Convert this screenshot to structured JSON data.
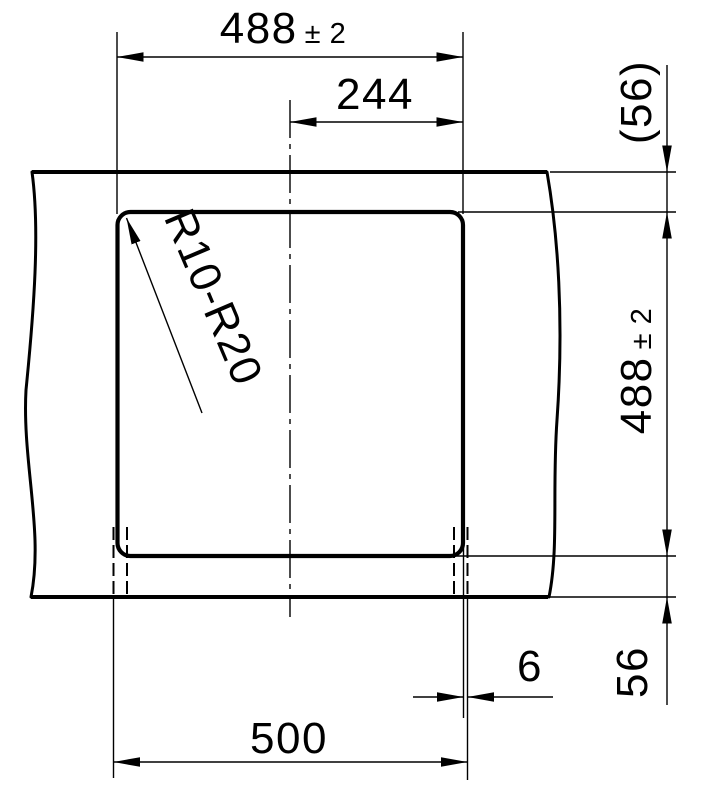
{
  "dims": {
    "top_width": {
      "value": "488",
      "tol": "± 2"
    },
    "half_width": "244",
    "radius": "R10-R20",
    "bottom_width": "500",
    "gap": "6",
    "right_height": {
      "value": "488",
      "tol": "± 2"
    },
    "right_top": "(56)",
    "right_bottom": "56"
  },
  "colors": {
    "line": "#000000",
    "background": "#ffffff"
  }
}
